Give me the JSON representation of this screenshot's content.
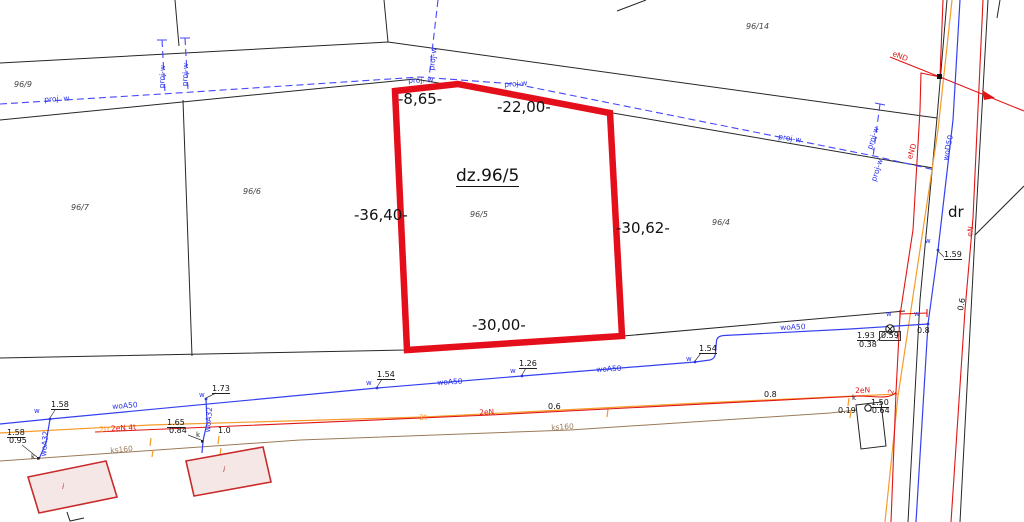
{
  "colors": {
    "parcel_outline": "#e40f1a",
    "water_line": "#3440f0",
    "projected_line": "#4646ff",
    "telecom_line": "#f59b2a",
    "sewer_line": "#9a7a58",
    "power_line": "#e01515",
    "boundary": "#262626",
    "building_fill": "#f6e7e7"
  },
  "parcel": {
    "title": "dz.96/5",
    "number": "96/5",
    "dims": {
      "top_left": "-8,65-",
      "top_right": "-22,00-",
      "left": "-36,40-",
      "right": "-30,62-",
      "bottom": "-30,00-"
    }
  },
  "parcels": {
    "p96_9": "96/9",
    "p96_7": "96/7",
    "p96_6": "96/6",
    "p96_4": "96/4",
    "p96_14": "96/14"
  },
  "road": {
    "label": "dr"
  },
  "lines": {
    "proj_w": "proj. w",
    "proj_w_dash": "proj-w",
    "woA50": "woA50",
    "woA32": "woA32",
    "woD50": "woD50",
    "ks160": "ks160",
    "two_eN": "2eN",
    "two_tr": "2tr",
    "eN_4t": "2eN 4t",
    "two_t": "2t",
    "eND": "eND",
    "eN": "eN"
  },
  "markers": {
    "w": "w",
    "k": "k",
    "i": "i",
    "two": "2"
  },
  "depths": {
    "d1": "1.58",
    "d2": "0.95",
    "d3": "1.73",
    "d4": "1.58",
    "d5": "1.65",
    "d6": "0.84",
    "d7": "1.0",
    "d8": "1.54",
    "d9": "1.26",
    "d10": "1.54",
    "d11": "1.93",
    "d12": "0.38",
    "d13": "0.59",
    "d14": "0.8",
    "d15": "0.8",
    "d16": "0.6",
    "d17": "0.6",
    "d18": "0.19",
    "d19": "1.50",
    "d20": "-0.64",
    "d21": "1.59"
  }
}
